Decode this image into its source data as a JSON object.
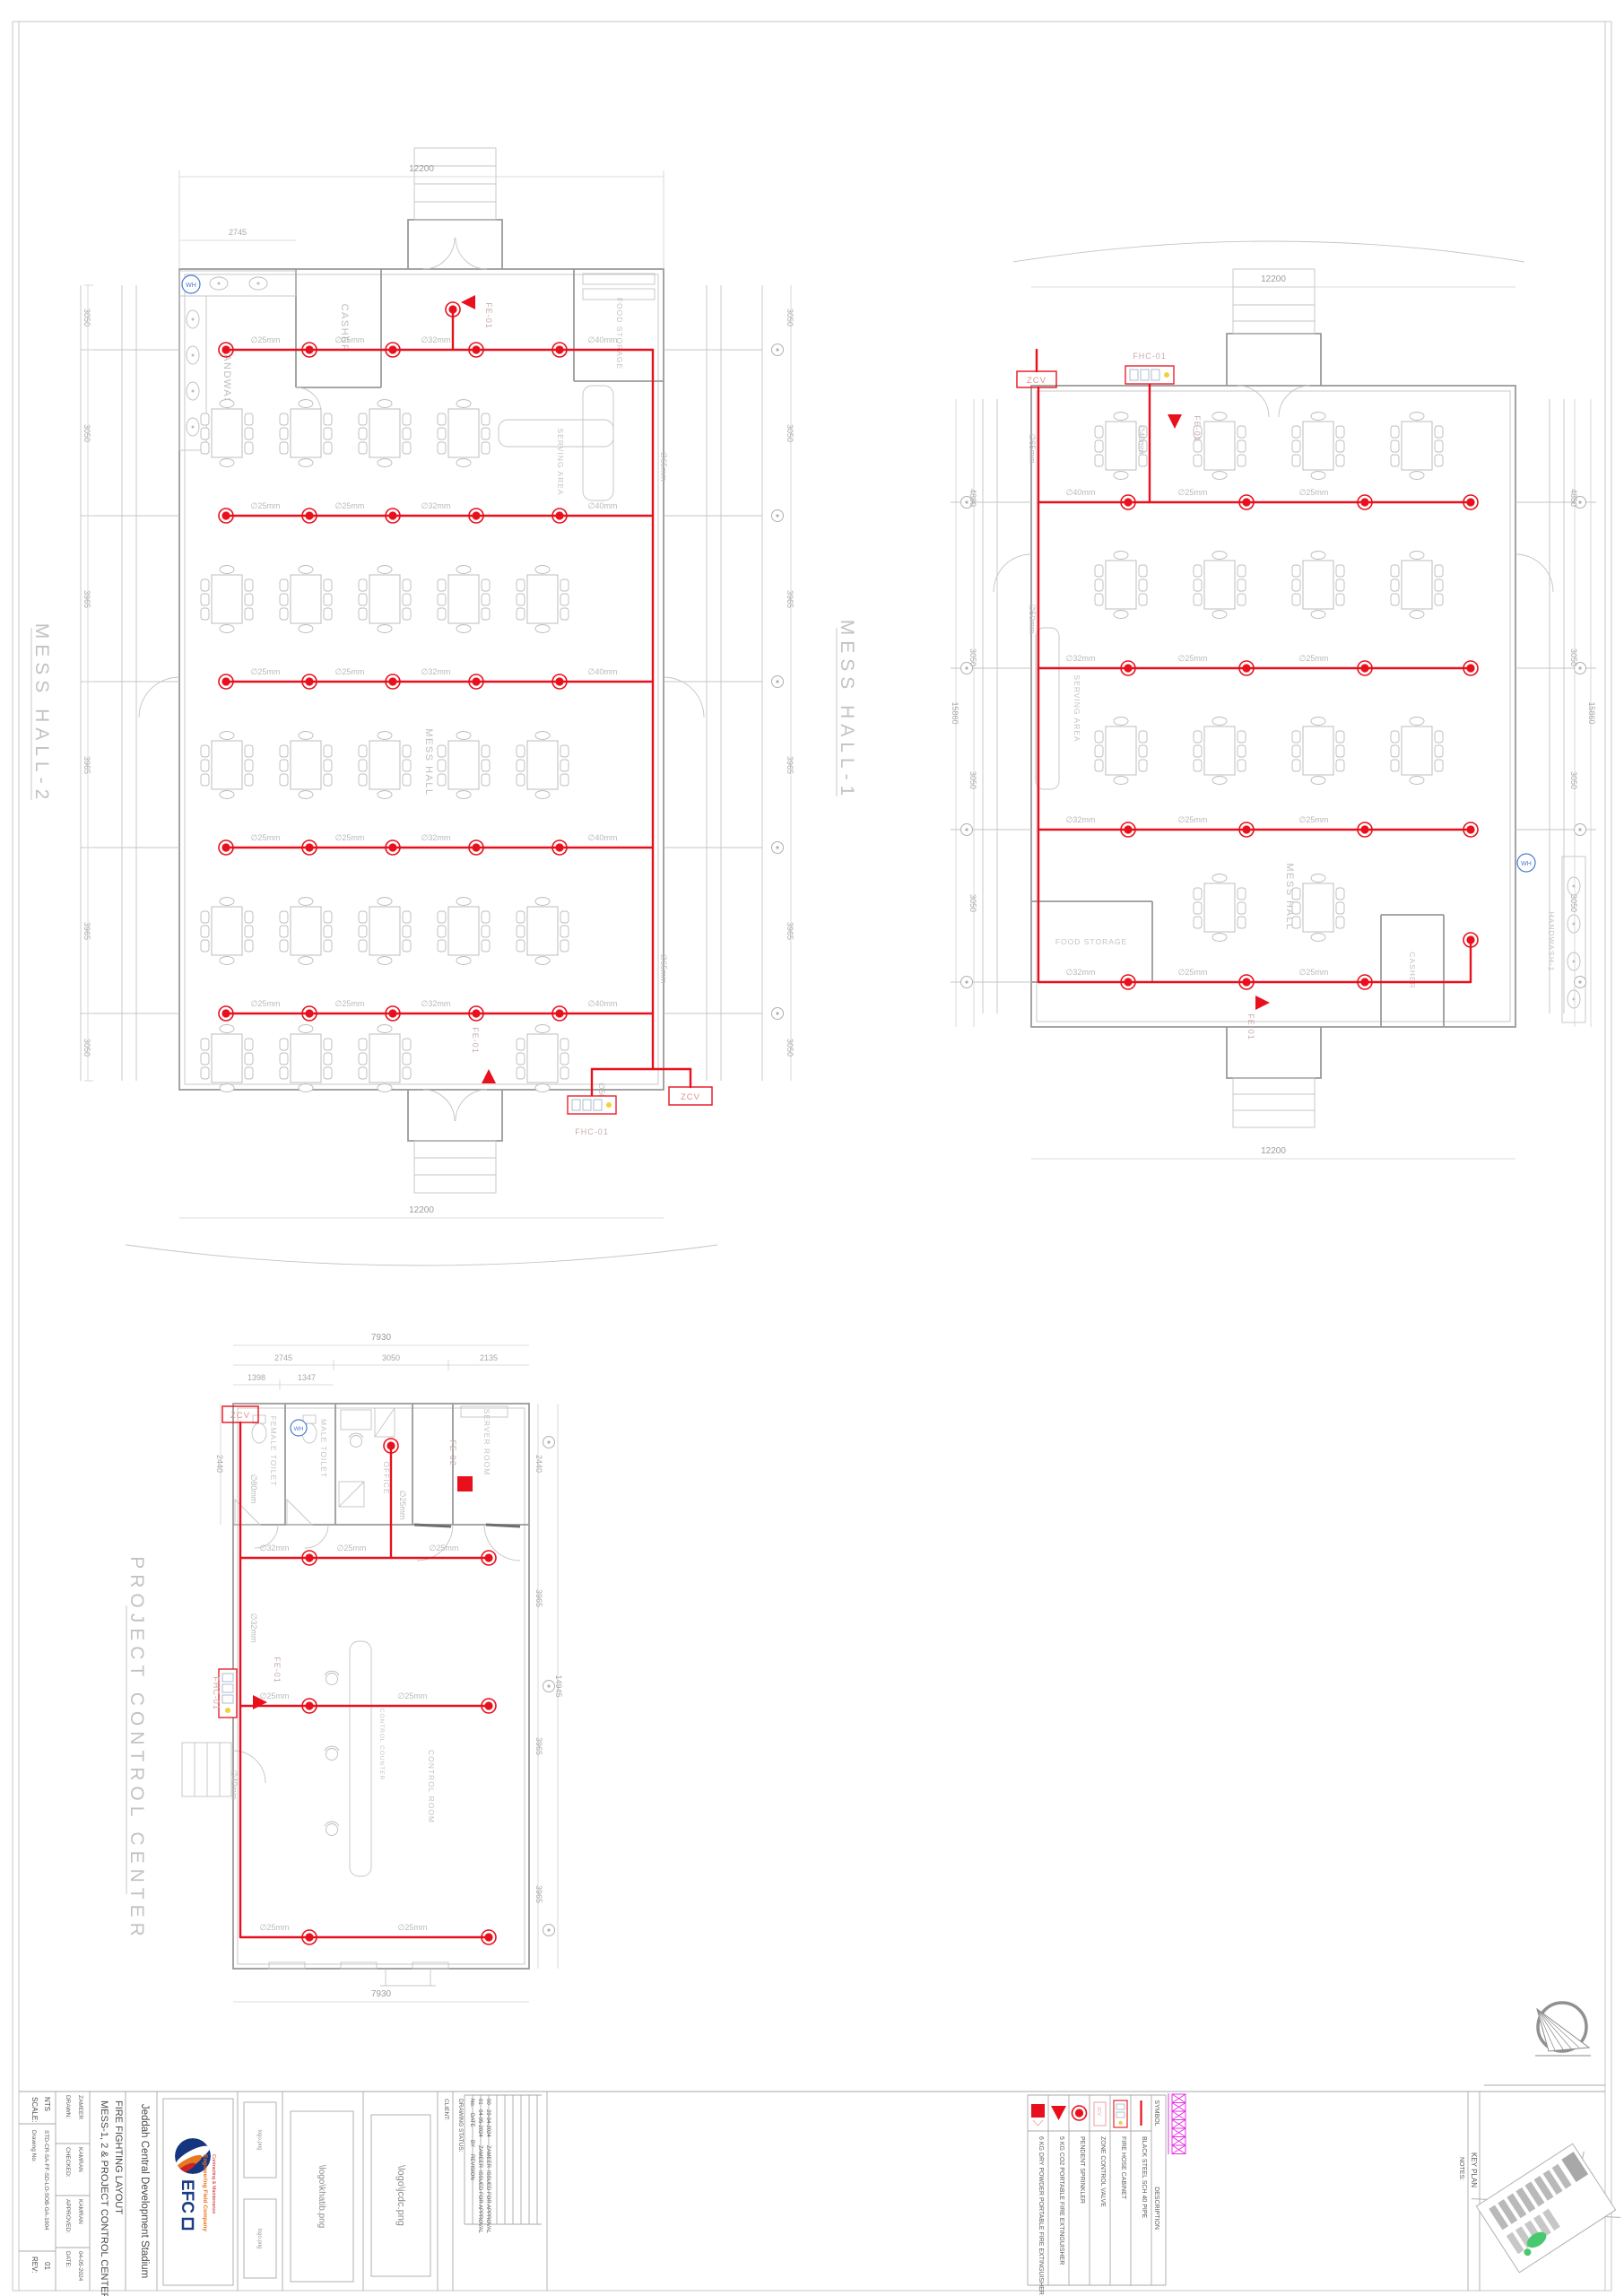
{
  "pipe_sizes": {
    "s25": "∅25mm",
    "s32": "∅32mm",
    "s40": "∅40mm",
    "s50": "∅50mm",
    "s65": "∅65mm",
    "s80": "∅80mm"
  },
  "plans": {
    "mh2": {
      "title": "MESS HALL-2",
      "rooms": {
        "casher": "CASHER",
        "handwash": "HANDWASH-2",
        "food_storage": "FOOD STORAGE",
        "serving": "SERVING AREA",
        "hall": "MESS HALL",
        "wh": "WH"
      },
      "devices": {
        "fe": "FE-01",
        "fhc": "FHC-01",
        "zcv": "ZCV"
      },
      "dims": {
        "top": "12200",
        "bottom": "12200",
        "handwash_w": "2745",
        "left": [
          "3050",
          "3050",
          "3965",
          "3965",
          "3965",
          "3050"
        ],
        "right": [
          "3050",
          "3050",
          "3965",
          "3965",
          "3965",
          "3050"
        ]
      }
    },
    "mh1": {
      "title": "MESS HALL-1",
      "rooms": {
        "casher": "CASHER",
        "handwash": "HANDWASH-1",
        "food_storage": "FOOD STORAGE",
        "serving": "SERVING AREA",
        "hall": "MESS HALL",
        "wh": "WH"
      },
      "devices": {
        "fe": "FE-01",
        "fhc": "FHC-01",
        "zcv": "ZCV"
      },
      "dims": {
        "top": "12200",
        "bottom": "12200",
        "left": [
          "4880",
          "3050",
          "3050",
          "3050"
        ],
        "left_total": "15860",
        "right": [
          "4880",
          "3050",
          "3050",
          "3050"
        ],
        "right_total": "15860"
      }
    },
    "pcc": {
      "title": "PROJECT CONTROL CENTER",
      "rooms": {
        "female_toilet": "FEMALE TOILET",
        "male_toilet": "MALE TOILET",
        "office": "OFFICE",
        "server_room": "SERVER ROOM",
        "control_room": "CONTROL ROOM",
        "control_counter": "CONTROL COUNTER",
        "wh": "WH"
      },
      "devices": {
        "fe1": "FE-01",
        "fe2": "FE-02",
        "fhc": "FHC-01",
        "zcv": "ZCV"
      },
      "dims": {
        "top_total": "7930",
        "bottom_total": "7930",
        "top_row": [
          "2745",
          "3050",
          "2135"
        ],
        "top_row2": [
          "1398",
          "1347"
        ],
        "left_h": "2440",
        "right": [
          "2440",
          "3965",
          "3965",
          "3965"
        ],
        "right_total": "14945"
      }
    }
  },
  "title_block": {
    "scale_label": "SCALE:",
    "scale": "NTS",
    "drawn_label": "DRAWN:",
    "drawn": "ZAMEER",
    "checked_label": "CHECKED:",
    "checked": "KAMRAN",
    "approved_label": "APPROVED:",
    "approved": "KAMRAN",
    "date_label": "DATE:",
    "date": "04-05-2024",
    "dwg_label": "Drawing No:",
    "dwg_no": "STD-CR-SA-FF-SD-LO-SOB-GA-1004",
    "rev_label": "REV:",
    "rev": "01",
    "title_line1": "MESS-1, 2 & PROJECT CONTROL CENTER",
    "title_line2": "FIRE FIGHTING LAYOUT",
    "project": "Jeddah Central Development Stadium",
    "company": {
      "name": "EFC",
      "line1": "Engineering Field Company",
      "line2": "Contracting & Maintenance"
    },
    "logos": {
      "small1": "logo.png",
      "small2": "logo.png",
      "khatib": "\\logo\\khatib.png",
      "jcdc": "\\logo\\jcdc.png"
    },
    "client_label": "CLIENT:",
    "status_label": "DRAWING STATUS:",
    "revision_table": {
      "headers": [
        "No.",
        "DATE",
        "BY",
        "REVISION"
      ],
      "rows": [
        [
          "01",
          "04-05-2024",
          "ZAMEER",
          "ISSUED FOR APPROVAL"
        ],
        [
          "00",
          "29-04-2024",
          "ZAMEER",
          "ISSUED FOR APPROVAL"
        ]
      ]
    },
    "notes_label": "NOTES:",
    "key_plan_label": "KEY PLAN"
  },
  "legend": {
    "symbol_header": "SYMBOL",
    "description_header": "DESCRIPTION",
    "items": [
      {
        "name": "pipe",
        "description": "BLACK STEEL SCH 40 PIPE"
      },
      {
        "name": "fire-hose-cabinet",
        "description": "FIRE HOSE CABINET"
      },
      {
        "name": "zone-control-valve",
        "description": "ZONE CONTROL VALVE"
      },
      {
        "name": "pendent-sprinkler",
        "description": "PENDENT SPRINKLER"
      },
      {
        "name": "co2-extinguisher",
        "description": "5 KG CO2 PORTABLE FIRE EXTINGUISHER"
      },
      {
        "name": "dry-powder-extinguisher",
        "description": "6 KG DRY POWDER PORTABLE FIRE EXTINGUISHER"
      }
    ]
  },
  "colors": {
    "pipe_red": "#e8101c",
    "magenta": "#e530e5",
    "blue": "#4a7bd0"
  }
}
